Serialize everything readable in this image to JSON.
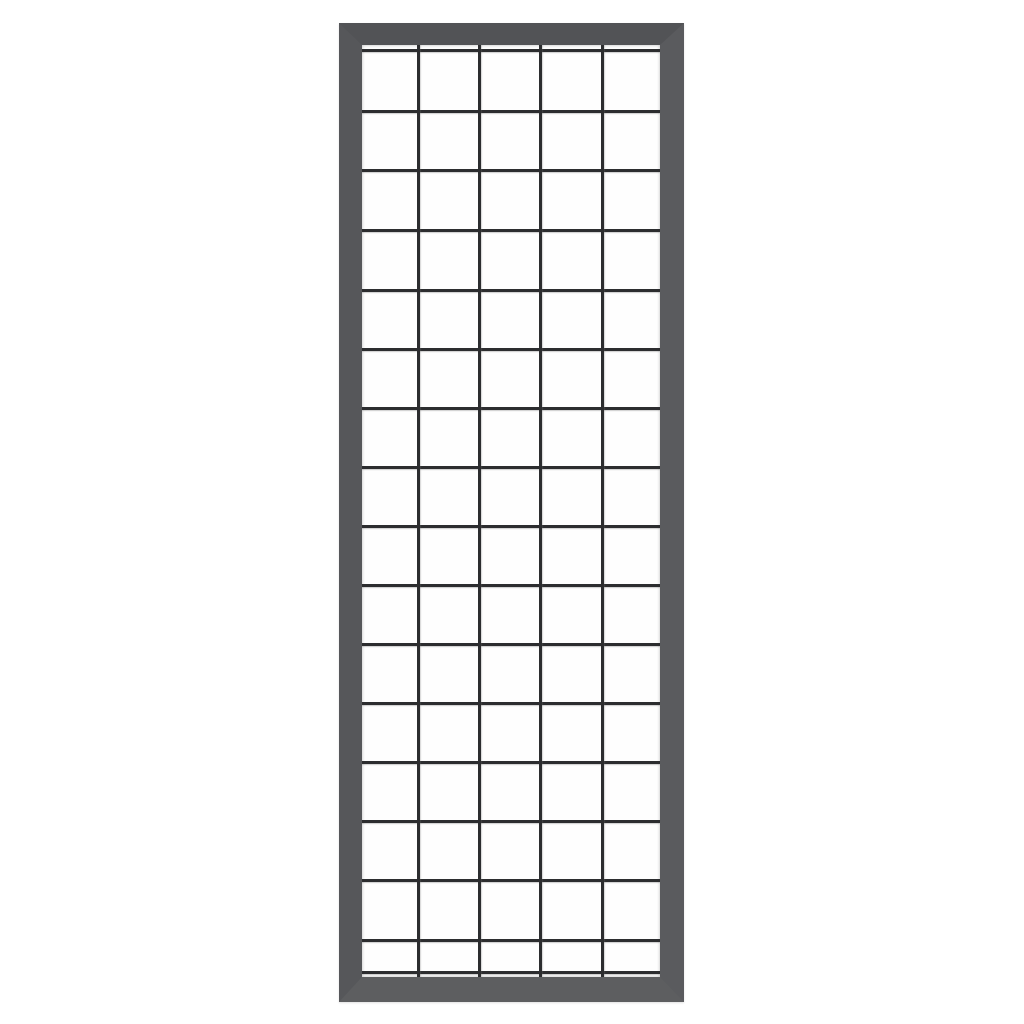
{
  "scene": {
    "type": "product-photo",
    "description": "Upright rectangular anthracite grey metal trellis panel with a welded square wire mesh grid, centered on a plain white background",
    "background_color": "#ffffff"
  },
  "panel": {
    "frame": {
      "material_color": "#56575a",
      "color_top": "#525356",
      "color_right": "#5a5b5e",
      "color_bottom": "#5d5e60",
      "color_left": "#56575a",
      "corner_style": "mitered"
    },
    "mesh": {
      "background_color": "#fefefe",
      "wire_color": "#2c2d2f",
      "wire_thickness_px": 3,
      "columns": 5,
      "full_rows": 15,
      "has_partial_bottom_row": true,
      "vertical_wire_x_px": [
        56,
        117,
        178,
        240
      ],
      "horizontal_wire_y_px": [
        5,
        66,
        125,
        185,
        245,
        304,
        363,
        422,
        481,
        540,
        599,
        658,
        717,
        776,
        835,
        895,
        927
      ]
    }
  }
}
